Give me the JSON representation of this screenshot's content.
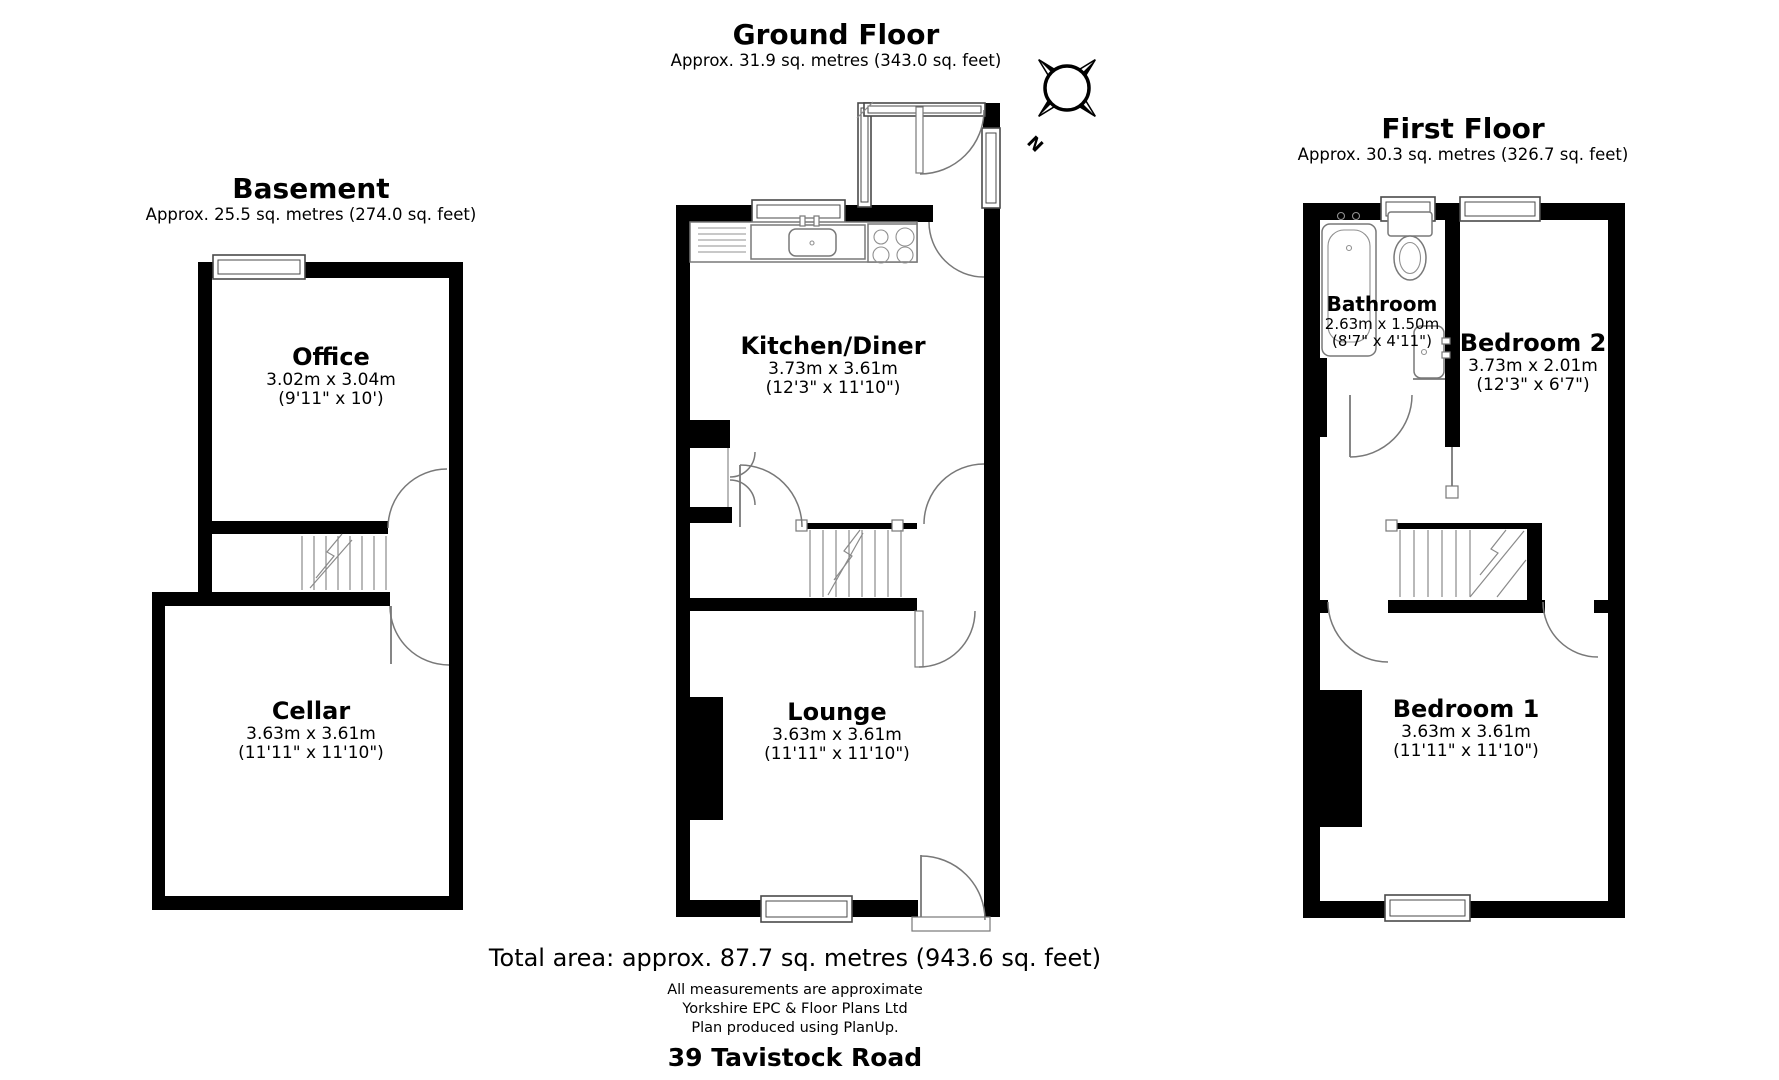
{
  "colors": {
    "wall": "#000000",
    "line": "#787878",
    "background": "#ffffff",
    "text": "#000000"
  },
  "floors": [
    {
      "id": "basement",
      "title": "Basement",
      "area": "Approx. 25.5 sq. metres (274.0 sq. feet)",
      "rooms": [
        {
          "name": "Office",
          "metric": "3.02m x 3.04m",
          "imperial": "(9'11\" x 10')"
        },
        {
          "name": "Cellar",
          "metric": "3.63m x 3.61m",
          "imperial": "(11'11\" x 11'10\")"
        }
      ]
    },
    {
      "id": "ground",
      "title": "Ground Floor",
      "area": "Approx. 31.9 sq. metres (343.0 sq. feet)",
      "rooms": [
        {
          "name": "Kitchen/Diner",
          "metric": "3.73m x 3.61m",
          "imperial": "(12'3\" x 11'10\")"
        },
        {
          "name": "Lounge",
          "metric": "3.63m x 3.61m",
          "imperial": "(11'11\" x 11'10\")"
        }
      ]
    },
    {
      "id": "first",
      "title": "First Floor",
      "area": "Approx. 30.3 sq. metres (326.7 sq. feet)",
      "rooms": [
        {
          "name": "Bathroom",
          "metric": "2.63m x 1.50m",
          "imperial": "(8'7\" x 4'11\")"
        },
        {
          "name": "Bedroom 2",
          "metric": "3.73m x 2.01m",
          "imperial": "(12'3\" x 6'7\")"
        },
        {
          "name": "Bedroom 1",
          "metric": "3.63m x 3.61m",
          "imperial": "(11'11\" x 11'10\")"
        }
      ]
    }
  ],
  "compass": {
    "north_label": "N"
  },
  "footer": {
    "total_area": "Total area: approx. 87.7 sq. metres (943.6 sq. feet)",
    "disclaimer_line1": "All measurements are approximate",
    "disclaimer_line2": "Yorkshire EPC & Floor Plans  Ltd",
    "disclaimer_line3": "Plan produced using PlanUp.",
    "address": "39 Tavistock Road"
  }
}
